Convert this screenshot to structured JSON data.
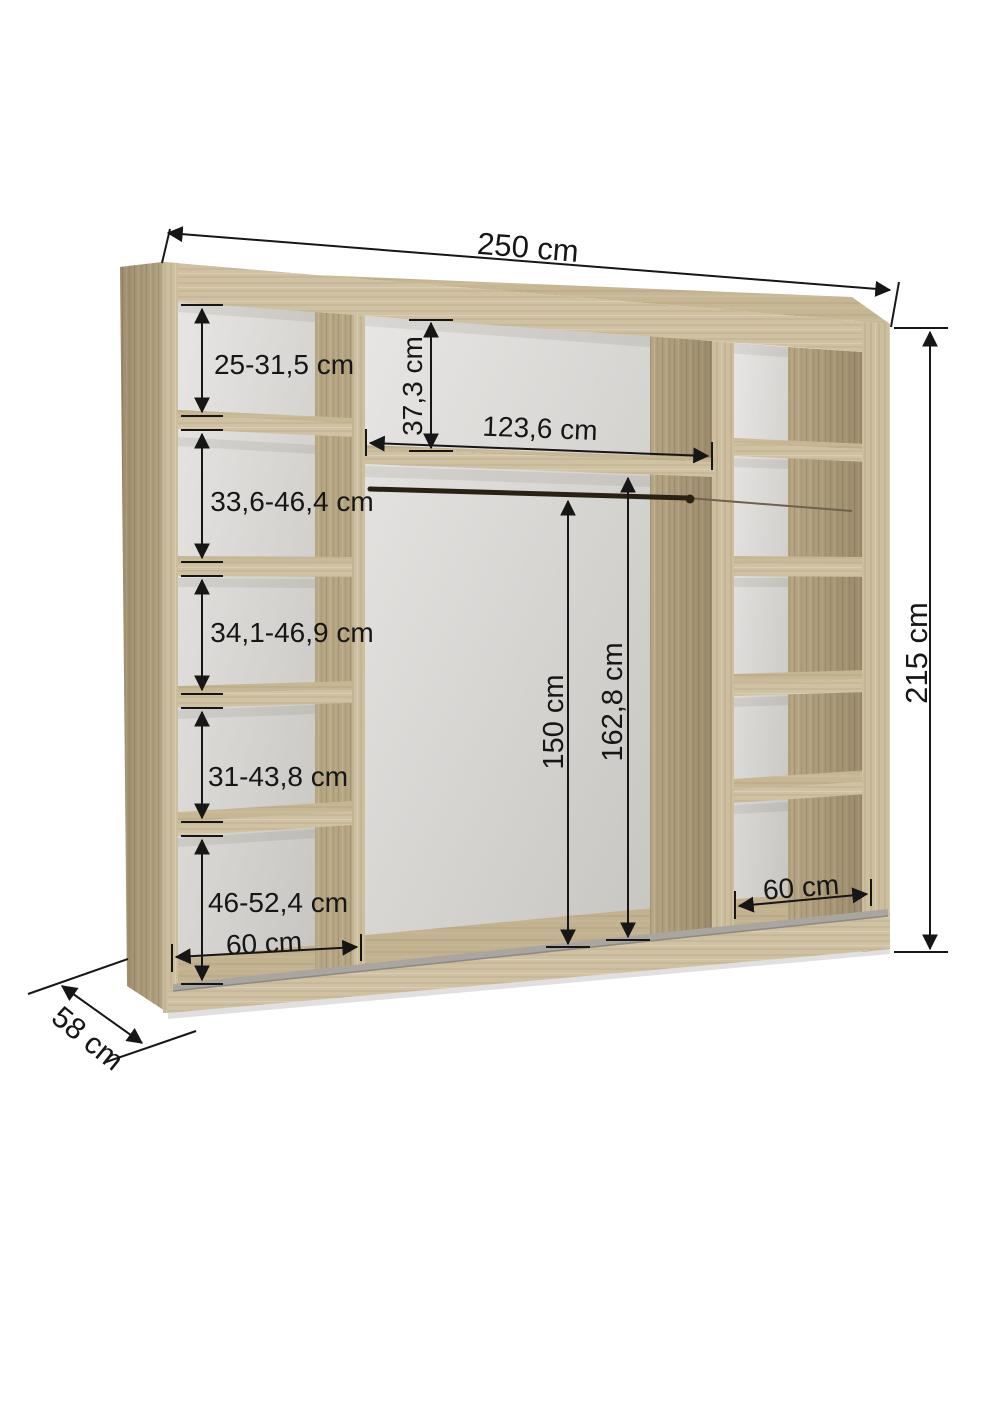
{
  "diagram": "wardrobe-interior-dimension-drawing",
  "colors": {
    "background": "#ffffff",
    "wood_front": "#cdbe9e",
    "wood_side": "#b7a684",
    "wood_top": "#c6b693",
    "interior_wall": "#dddbd7",
    "floor_track": "#a9a6a1",
    "rod": "#2a2115",
    "dimension_line": "#161616"
  },
  "dimensions": {
    "total_width": "250 cm",
    "total_height": "215 cm",
    "depth": "58 cm",
    "left_column": {
      "compartments": [
        "25-31,5 cm",
        "33,6-46,4 cm",
        "34,1-46,9 cm",
        "31-43,8 cm",
        "46-52,4 cm"
      ],
      "width": "60 cm"
    },
    "middle": {
      "top_shelf_height": "37,3 cm",
      "inner_width": "123,6 cm",
      "rod_height": "150 cm",
      "inner_height": "162,8 cm"
    },
    "right_column": {
      "width": "60 cm"
    }
  }
}
